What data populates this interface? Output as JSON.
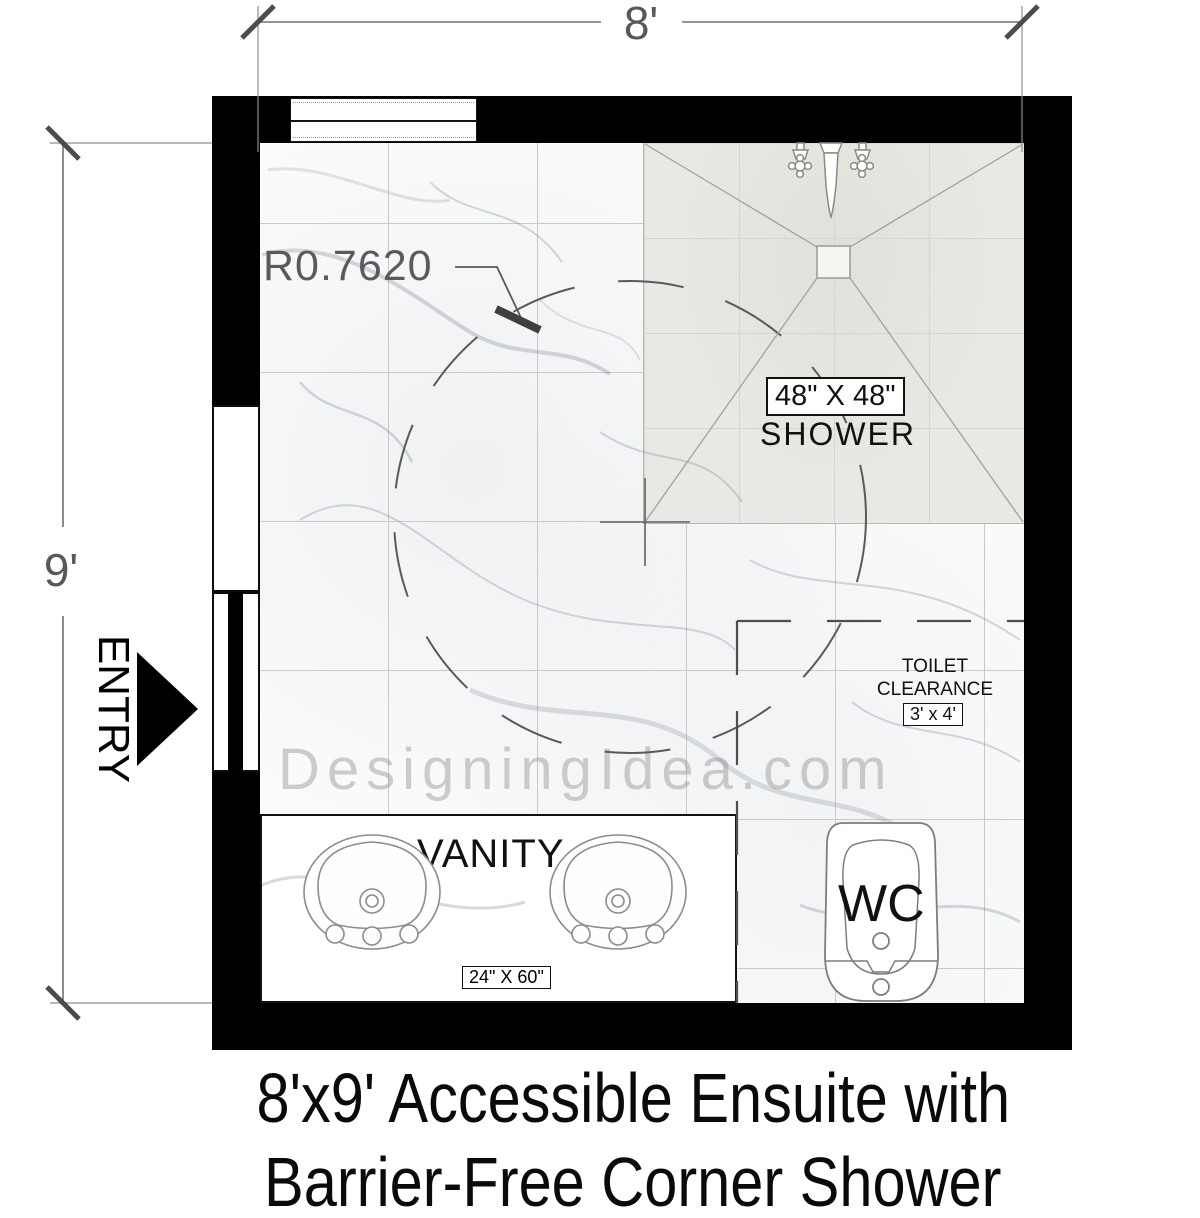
{
  "dimensions": {
    "width_label": "8'",
    "height_label": "9'"
  },
  "entry_label": "ENTRY",
  "radius_label": "R0.7620",
  "shower": {
    "size_label": "48\" X 48\"",
    "name_label": "SHOWER"
  },
  "toilet_clearance": {
    "line1": "TOILET",
    "line2": "CLEARANCE",
    "size_label": "3' x 4'"
  },
  "vanity": {
    "name_label": "VANITY",
    "size_label": "24\" X 60\""
  },
  "wc_label": "WC",
  "watermark": "DesigningIdea.com",
  "title": {
    "line1": "8'x9' Accessible Ensuite with",
    "line2": "Barrier-Free Corner Shower"
  },
  "colors": {
    "wall": "#000000",
    "dimension": "#58585a",
    "shower_fill": "#e9e8e4",
    "tile_line": "#c9c9c9",
    "watermark": "#9e9e9e"
  }
}
